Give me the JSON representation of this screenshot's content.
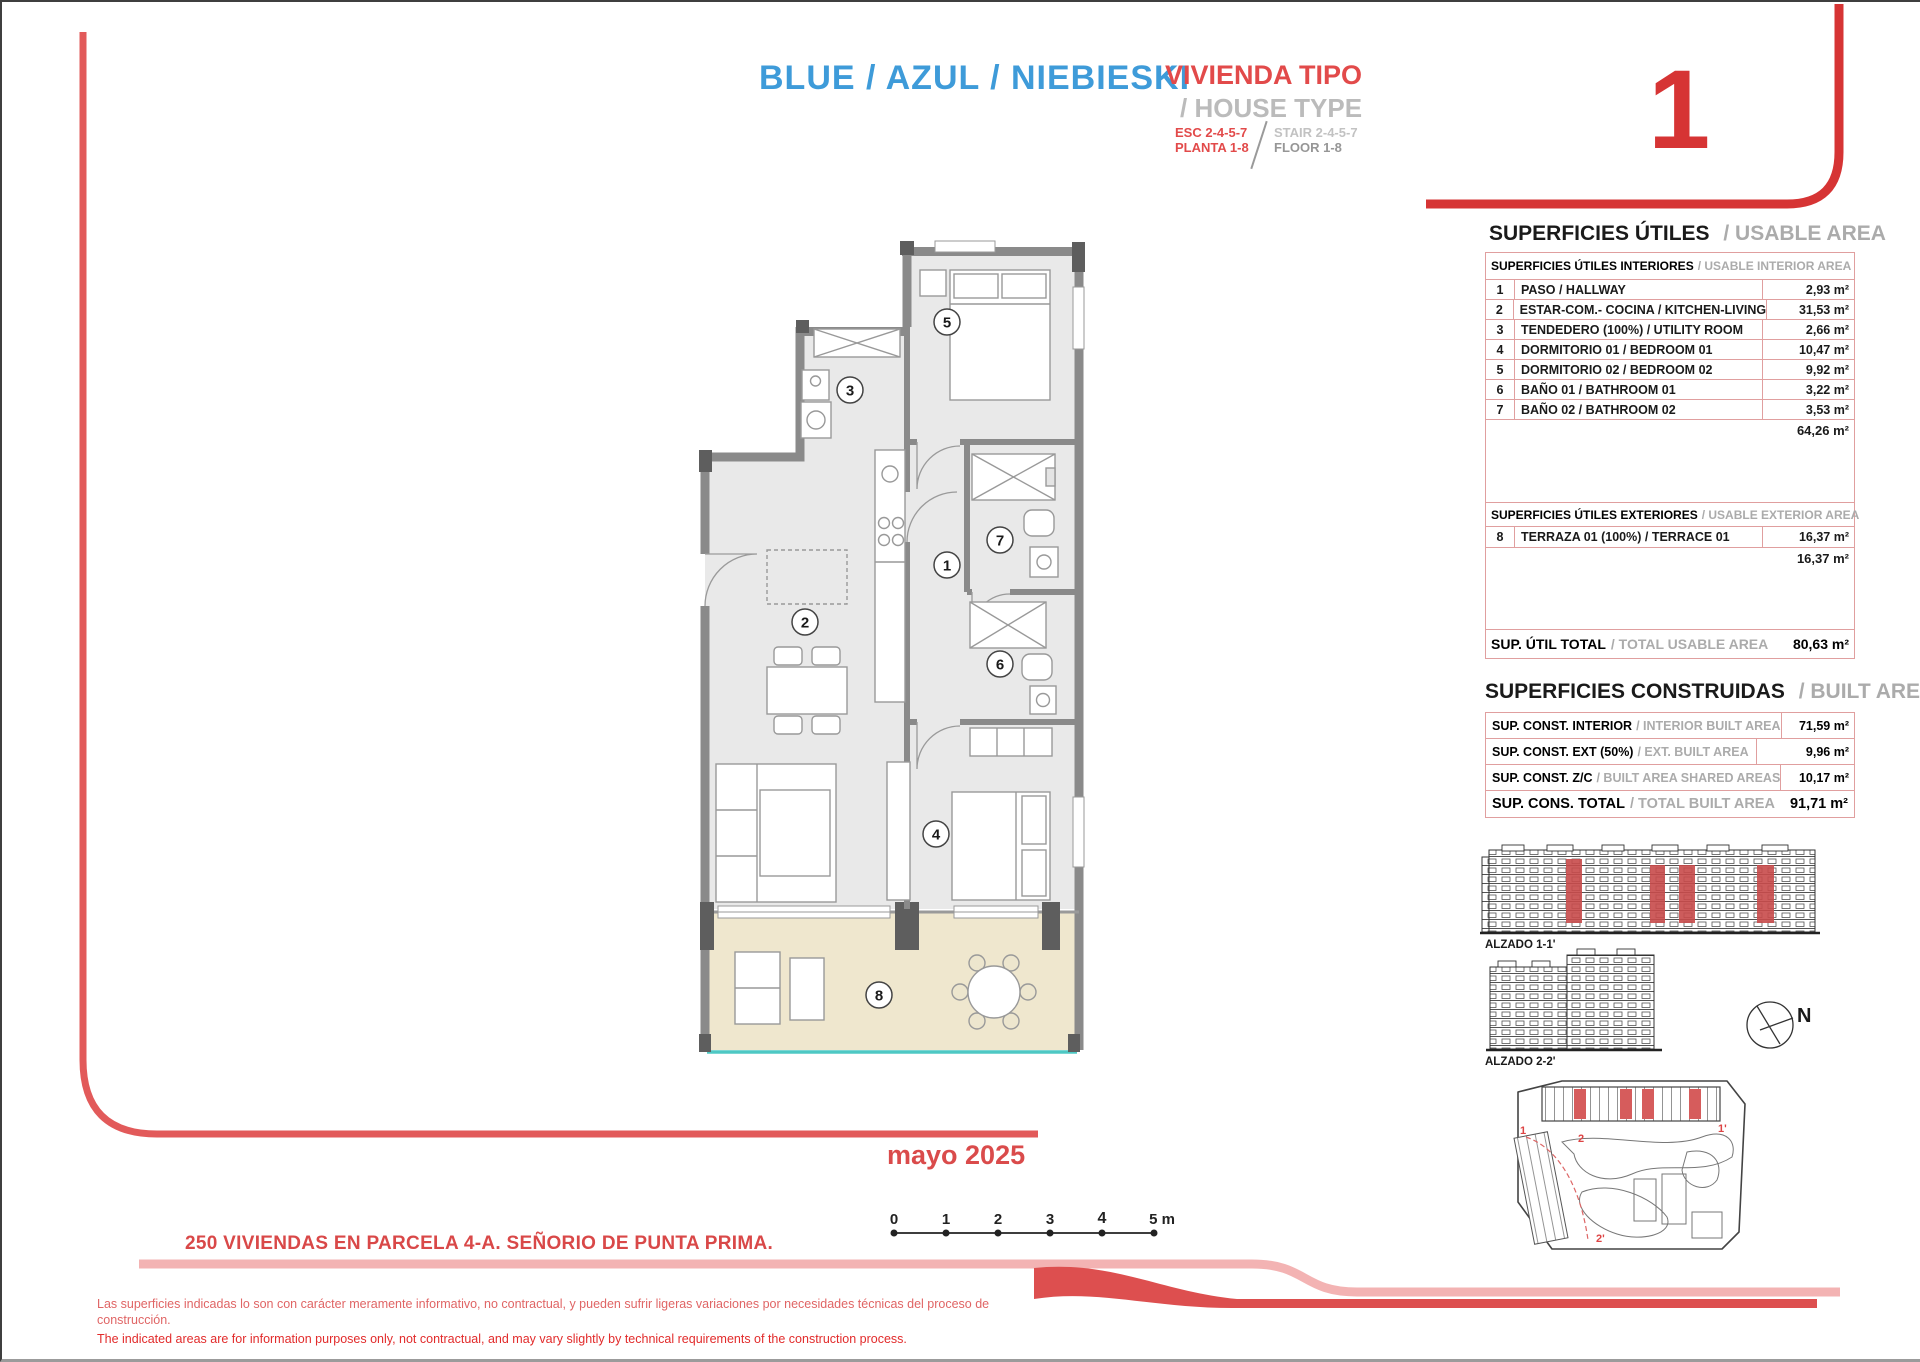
{
  "header": {
    "title_languages": "BLUE / AZUL / NIEBIESKI",
    "type_label_es": "VIVIENDA TIPO",
    "type_label_en": "/ HOUSE TYPE",
    "stair_es_1": "ESC 2-4-5-7",
    "stair_es_2": "PLANTA 1-8",
    "stair_en_1": "STAIR 2-4-5-7",
    "stair_en_2": "FLOOR 1-8",
    "house_type_number": "1"
  },
  "usable_area": {
    "title_es": "SUPERFICIES ÚTILES",
    "title_en": "/ USABLE AREA",
    "interior": {
      "header_es": "SUPERFICIES ÚTILES INTERIORES",
      "header_en": "/ USABLE INTERIOR AREA",
      "rows": [
        {
          "num": "1",
          "label": "PASO / HALLWAY",
          "area": "2,93 m²"
        },
        {
          "num": "2",
          "label": "ESTAR-COM.- COCINA / KITCHEN-LIVING",
          "area": "31,53 m²"
        },
        {
          "num": "3",
          "label": "TENDEDERO (100%) / UTILITY ROOM",
          "area": "2,66 m²"
        },
        {
          "num": "4",
          "label": "DORMITORIO 01 / BEDROOM 01",
          "area": "10,47 m²"
        },
        {
          "num": "5",
          "label": "DORMITORIO 02 / BEDROOM 02",
          "area": "9,92 m²"
        },
        {
          "num": "6",
          "label": "BAÑO 01 / BATHROOM 01",
          "area": "3,22 m²"
        },
        {
          "num": "7",
          "label": "BAÑO 02 / BATHROOM 02",
          "area": "3,53 m²"
        }
      ],
      "subtotal": "64,26 m²"
    },
    "exterior": {
      "header_es": "SUPERFICIES ÚTILES EXTERIORES",
      "header_en": "/ USABLE EXTERIOR AREA",
      "rows": [
        {
          "num": "8",
          "label": "TERRAZA 01 (100%) / TERRACE 01",
          "area": "16,37 m²"
        }
      ],
      "subtotal": "16,37 m²"
    },
    "total_label_es": "SUP. ÚTIL TOTAL",
    "total_label_en": "/ TOTAL USABLE AREA",
    "total_value": "80,63 m²"
  },
  "built_area": {
    "title_es": "SUPERFICIES CONSTRUIDAS",
    "title_en": "/ BUILT AREA",
    "rows": [
      {
        "label_es": "SUP. CONST. INTERIOR",
        "label_en": "/ INTERIOR BUILT AREA",
        "value": "71,59 m²"
      },
      {
        "label_es": "SUP. CONST. EXT (50%)",
        "label_en": "/ EXT. BUILT AREA",
        "value": "9,96 m²"
      },
      {
        "label_es": "SUP. CONST. Z/C",
        "label_en": "/ BUILT AREA SHARED AREAS",
        "value": "10,17 m²"
      }
    ],
    "total_label_es": "SUP. CONS. TOTAL",
    "total_label_en": "/ TOTAL BUILT AREA",
    "total_value": "91,71 m²"
  },
  "plan": {
    "rooms": [
      "1",
      "2",
      "3",
      "4",
      "5",
      "6",
      "7",
      "8"
    ]
  },
  "elevations": {
    "label_1": "ALZADO 1-1'",
    "label_2": "ALZADO 2-2'",
    "north": "N"
  },
  "site_plan": {
    "markers": [
      "1",
      "1'",
      "2",
      "2'"
    ]
  },
  "footer": {
    "date": "mayo 2025",
    "project_title": "250 VIVIENDAS EN PARCELA 4-A. SEÑORIO DE PUNTA PRIMA.",
    "disclaimer_es_1": "Las superficies indicadas lo son con carácter meramente informativo, no contractual, y pueden sufrir ligeras variaciones por necesidades técnicas del proceso de",
    "disclaimer_es_2": "construcción.",
    "disclaimer_en": "The indicated areas are for information purposes only, not contractual, and may vary slightly by technical requirements of the construction process.",
    "scale_labels": [
      "0",
      "1",
      "2",
      "3",
      "4",
      "5 m"
    ]
  },
  "colors": {
    "title_blue": "#3E9BD9",
    "accent_red": "#D63434",
    "frame_salmon": "#E25A5A",
    "table_border_pink": "#E09F9F",
    "gray_text": "#ABABAB",
    "terrace_beige": "#EFE7CE",
    "glass_teal": "#4EC8C4"
  }
}
